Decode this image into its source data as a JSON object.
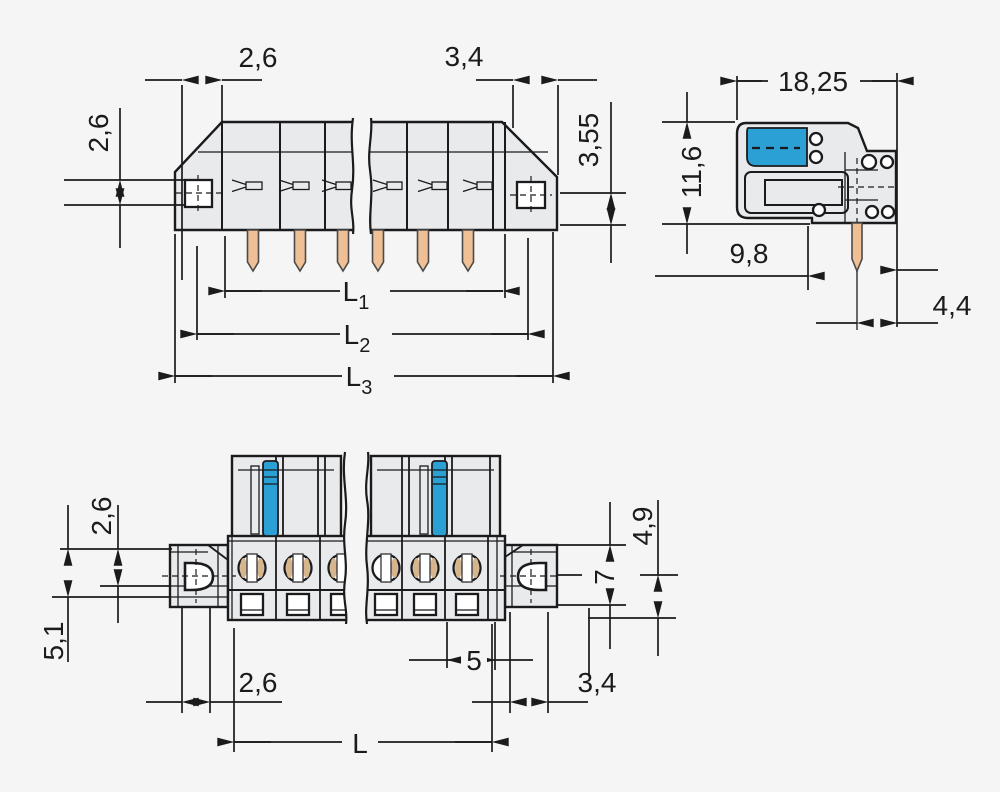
{
  "drawing": {
    "kind": "connector technical dimension drawing",
    "views": {
      "front": "front view with solder pins",
      "side": "side view",
      "bottom": "bottom view"
    },
    "pin_count_front": 6
  },
  "colors": {
    "background": "#f4f5f4",
    "housing_gray": "#e8eaec",
    "outline": "#1b1b1d",
    "lever_blue": "#2aa0d4",
    "pin_copper": "#efbf96"
  },
  "dims": {
    "front": {
      "d26_top": "2,6",
      "d34_top": "3,4",
      "d355": "3,55",
      "d26_left": "2,6",
      "l1": "L",
      "l1_sub": "1",
      "l2": "L",
      "l2_sub": "2",
      "l3": "L",
      "l3_sub": "3"
    },
    "side": {
      "d1825": "18,25",
      "d116": "11,6",
      "d98": "9,8",
      "d44": "4,4"
    },
    "bottom": {
      "d26_left": "2,6",
      "d51": "5,1",
      "d26_bottom": "2,6",
      "d5": "5",
      "d34": "3,4",
      "d49": "4,9",
      "d7": "7",
      "l": "L"
    }
  }
}
